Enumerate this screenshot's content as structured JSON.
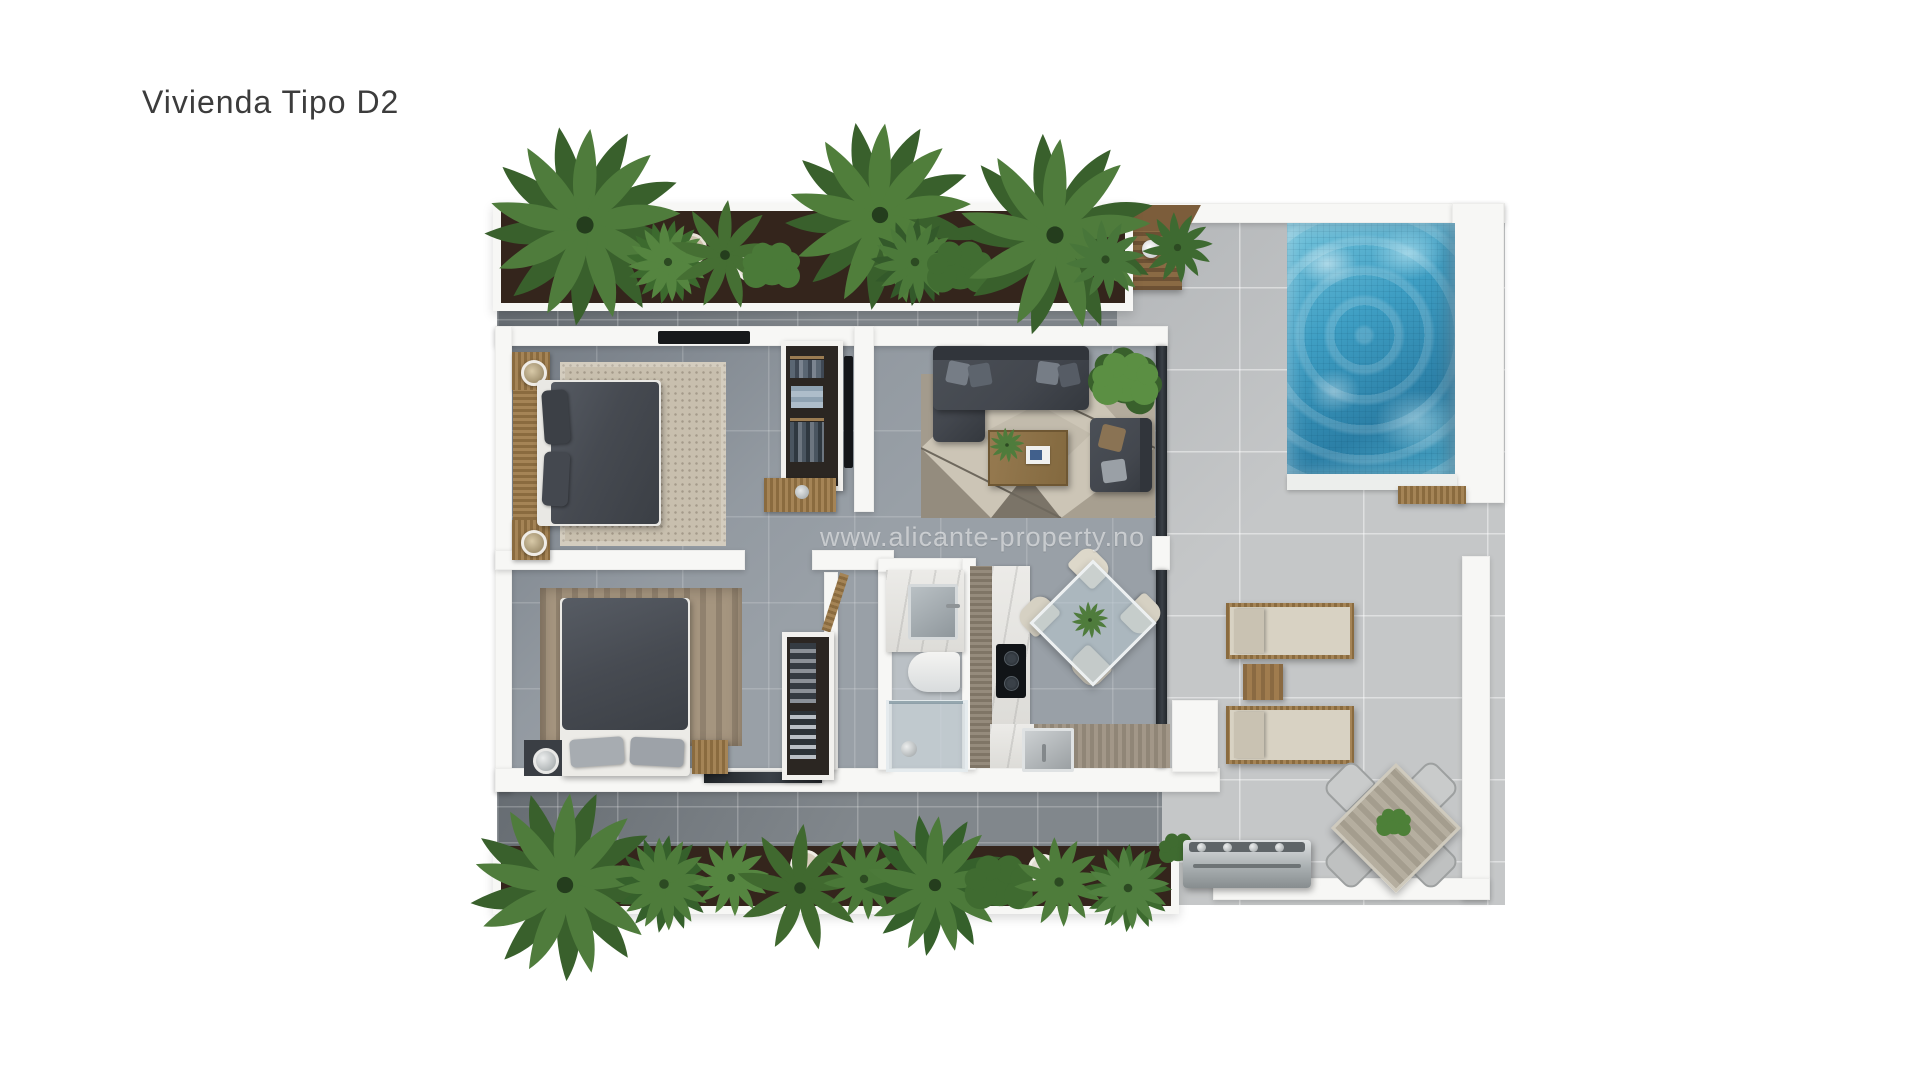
{
  "page": {
    "title": "Vivienda Tipo D2",
    "watermark": "www.alicante-property.no",
    "background": "#ffffff"
  },
  "plan": {
    "kind": "apartment-floor-plan-top-view",
    "features": [
      "top-planter-with-palms",
      "outdoor-shower-deck",
      "swimming-pool",
      "pool-bench",
      "terrace",
      "sun-lounger-1",
      "sun-lounger-2",
      "lounger-side-table",
      "outdoor-dining-table",
      "outdoor-dining-chairs",
      "bbq-grill",
      "bottom-planter-with-palms",
      "bedroom-1-double-bed",
      "bedroom-1-nightstands",
      "bedroom-1-rug",
      "bedroom-1-wardrobe",
      "bedroom-1-tv",
      "bedroom-1-desk",
      "bedroom-2-double-bed",
      "bedroom-2-nightstands",
      "bedroom-2-rug",
      "bedroom-2-closet",
      "bathroom-washbasin",
      "bathroom-toilet",
      "bathroom-shower",
      "kitchen-counter",
      "kitchen-cooktop",
      "kitchen-sink",
      "dining-glass-table",
      "dining-chairs",
      "sofa",
      "armchair",
      "coffee-table",
      "living-room-rug",
      "potted-plants",
      "sliding-glass-doors"
    ]
  },
  "colors": {
    "pageBg": "#ffffff",
    "titleColor": "#3c3c3c",
    "watermark": "rgba(255,255,255,0.52)",
    "poolWater": "#3e9ec3",
    "poolWaterDeep": "#2b7fa6",
    "wallWhite": "#f7f7f5",
    "houseFloor": "#99a0a7",
    "terraceFloor": "#c5c7c8",
    "walkway": "#81878c",
    "soil": "#34251c",
    "plantGreen": "#4f7c3c",
    "plantGreenDark": "#39602c",
    "wood": "#9d7a48",
    "woodLight": "#b8a268",
    "furnitureDark": "#43474e",
    "cushion": "#d8d2c3",
    "rugBeige": "#c8bfae",
    "rugBrown": "#a5957f",
    "steel": "#b9bdbf"
  }
}
